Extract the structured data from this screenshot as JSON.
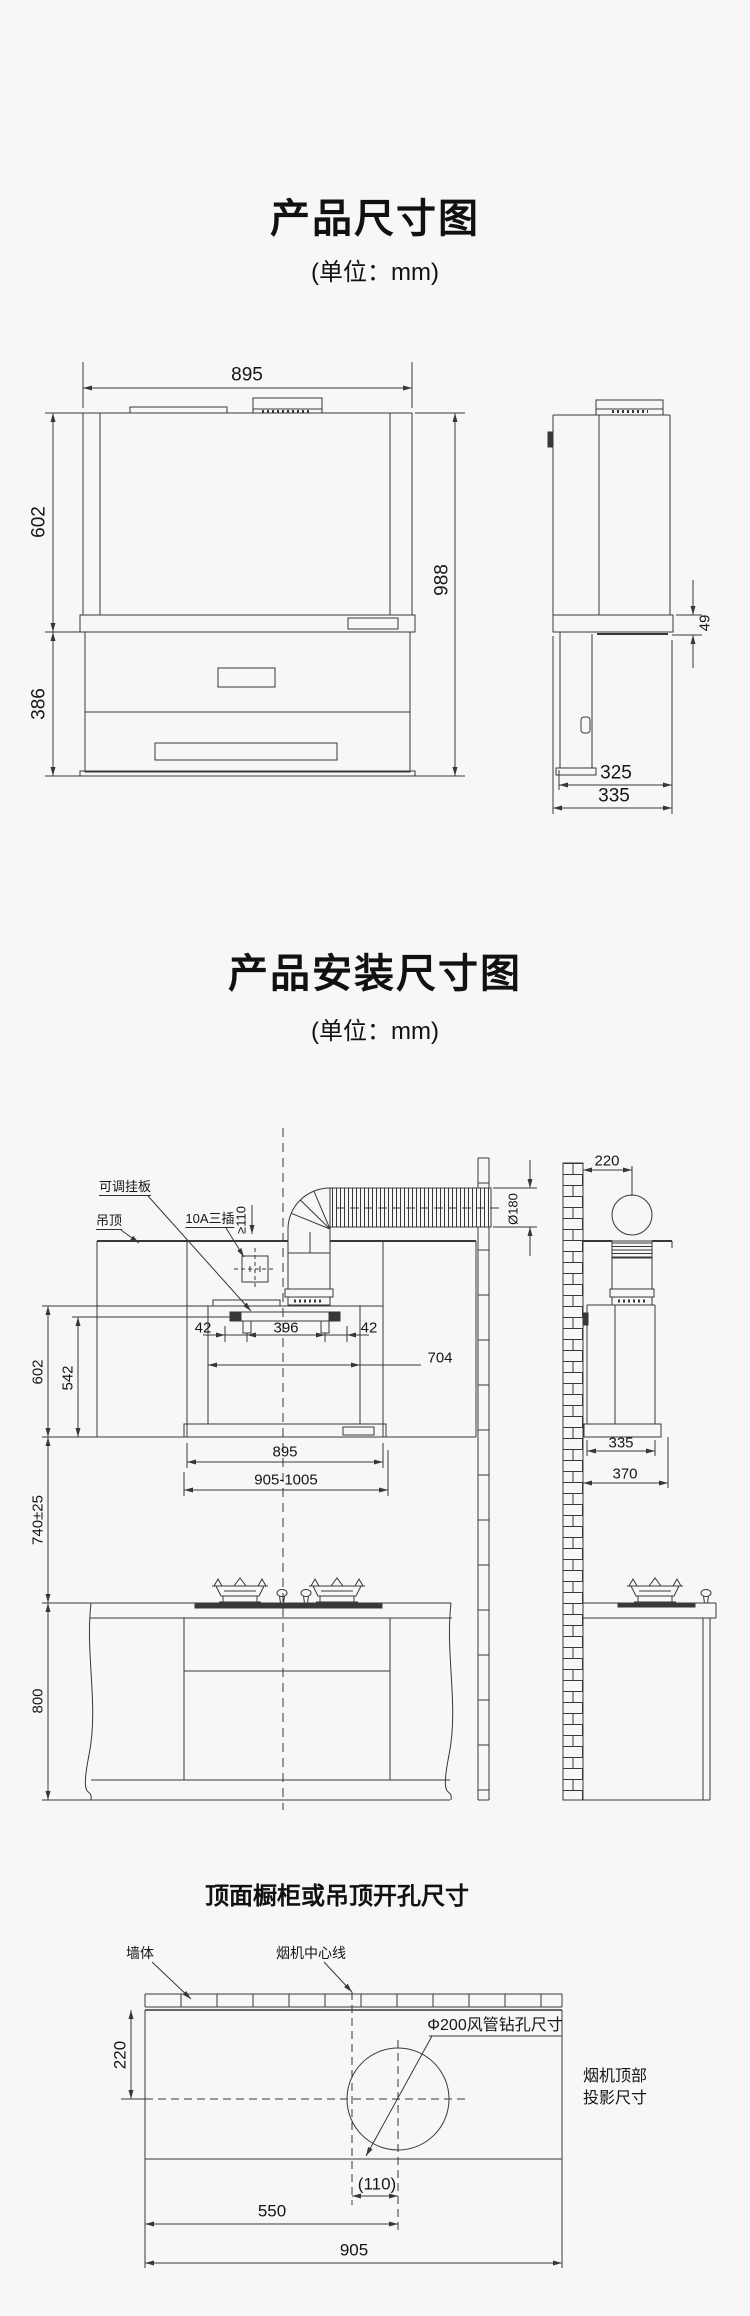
{
  "canvas": {
    "background": "#f7f7f7",
    "line_color": "#383838"
  },
  "section1": {
    "title": "产品尺寸图",
    "unit": "(单位：mm)",
    "front_dims": {
      "width": "895",
      "hood_height": "602",
      "stove_height": "386",
      "total_height": "988"
    },
    "side_dims": {
      "band_height": "49",
      "depth_inner": "325",
      "depth_outer": "335"
    }
  },
  "section2": {
    "title": "产品安装尺寸图",
    "unit": "(单位：mm)",
    "callouts": {
      "adjustable_plate": "可调挂板",
      "ceiling": "吊顶",
      "socket": "10A三插",
      "duct_clearance": "≥110",
      "duct_diameter": "Ø180"
    },
    "front_dims": {
      "hole_left_margin": "42",
      "hole_span": "396",
      "hole_right_margin": "42",
      "inner_width": "704",
      "hood_height": "602",
      "plate_to_bottom": "542",
      "hood_width": "895",
      "cabinet_opening": "905-1005",
      "hood_to_counter": "740±25",
      "counter_height": "800"
    },
    "side_dims": {
      "wall_to_duct_center": "220",
      "hood_depth": "335",
      "wall_to_front": "370"
    }
  },
  "section3": {
    "title": "顶面橱柜或吊顶开孔尺寸",
    "callouts": {
      "wall": "墙体",
      "hood_centerline": "烟机中心线",
      "drill_hole": "Φ200风管钻孔尺寸",
      "projection_line1": "烟机顶部",
      "projection_line2": "投影尺寸"
    },
    "dims": {
      "wall_to_hole_center": "220",
      "centerline_to_hole": "(110)",
      "left_to_hole_center": "550",
      "total_width": "905"
    }
  }
}
